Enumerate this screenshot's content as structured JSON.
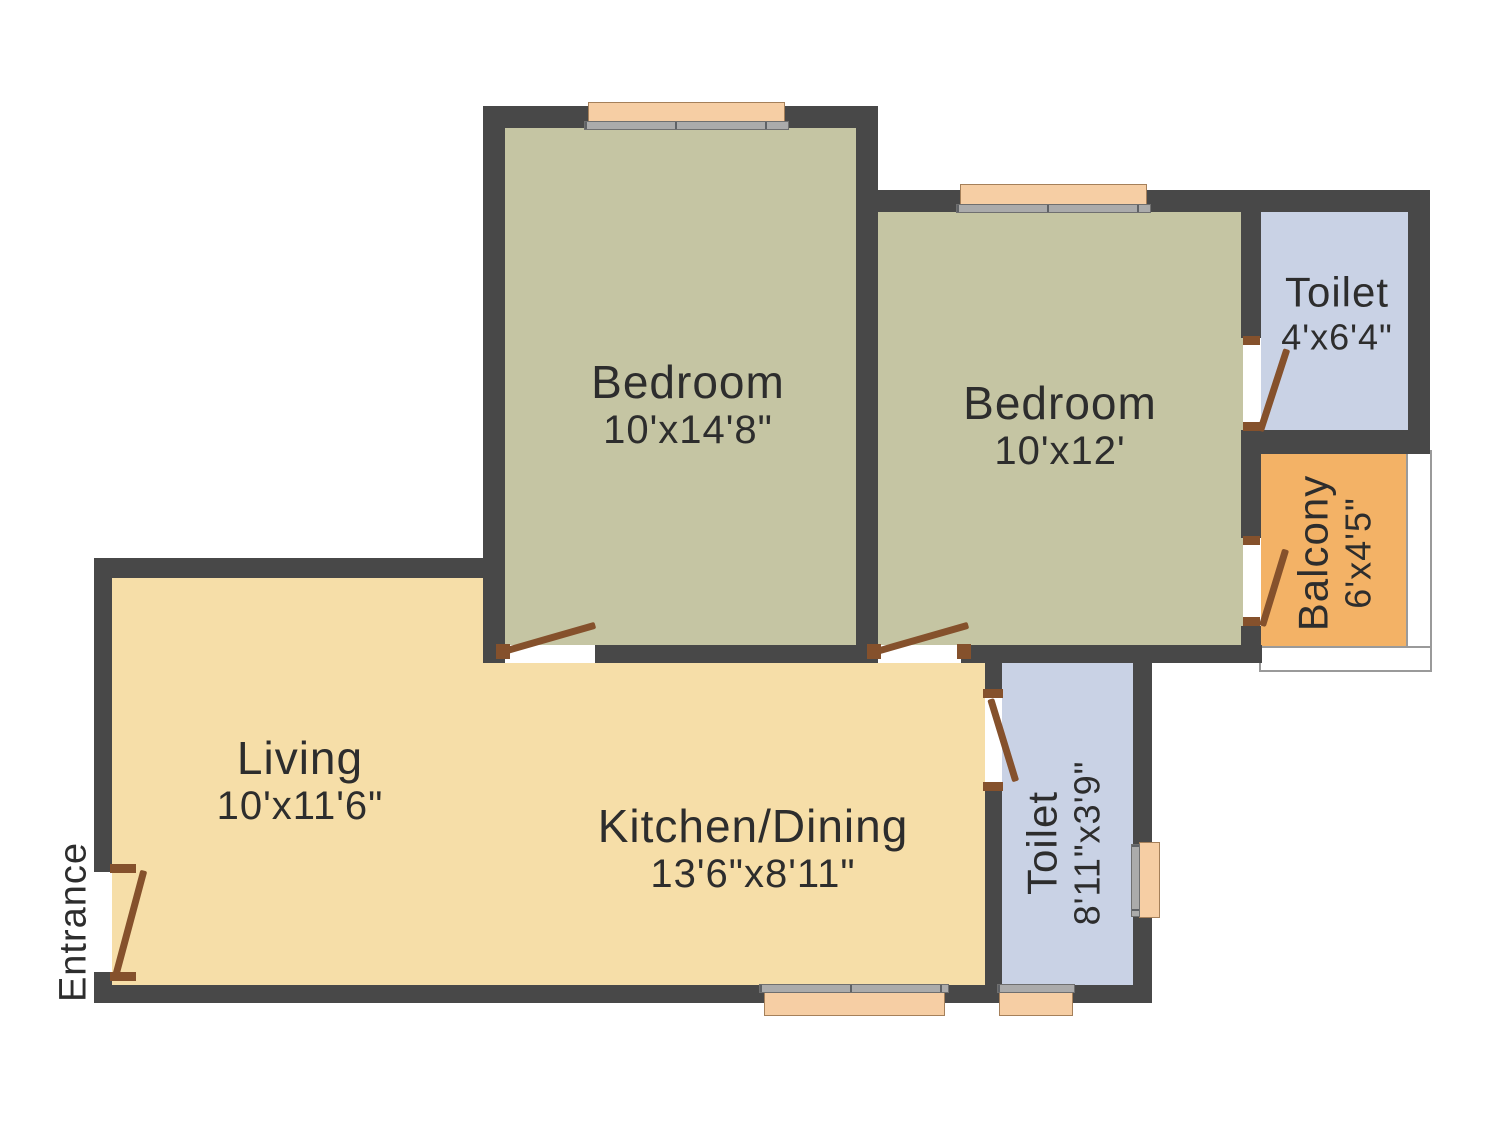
{
  "plan": {
    "rooms": [
      {
        "id": "bedroom-1",
        "label": "Bedroom",
        "dims": "10'x14'8\""
      },
      {
        "id": "bedroom-2",
        "label": "Bedroom",
        "dims": "10'x12'"
      },
      {
        "id": "toilet-top",
        "label": "Toilet",
        "dims": "4'x6'4\""
      },
      {
        "id": "balcony",
        "label": "Balcony",
        "dims": "6'x4'5\""
      },
      {
        "id": "living",
        "label": "Living",
        "dims": "10'x11'6\""
      },
      {
        "id": "kitchen-dining",
        "label": "Kitchen/Dining",
        "dims": "13'6\"x8'11\""
      },
      {
        "id": "toilet-bottom",
        "label": "Toilet",
        "dims": "8'11\"x3'9\""
      }
    ],
    "entrance_label": "Entrance",
    "colors": {
      "wall": "#484848",
      "bedroom": "#c5c5a3",
      "living": "#f6dea8",
      "toilet": "#c9d2e5",
      "balcony": "#f3b266",
      "window_frame": "#f6cea4",
      "window_sill": "#ababab",
      "door": "#85512c",
      "railing": "#9a9a9a",
      "text": "#2d2d2d"
    }
  }
}
